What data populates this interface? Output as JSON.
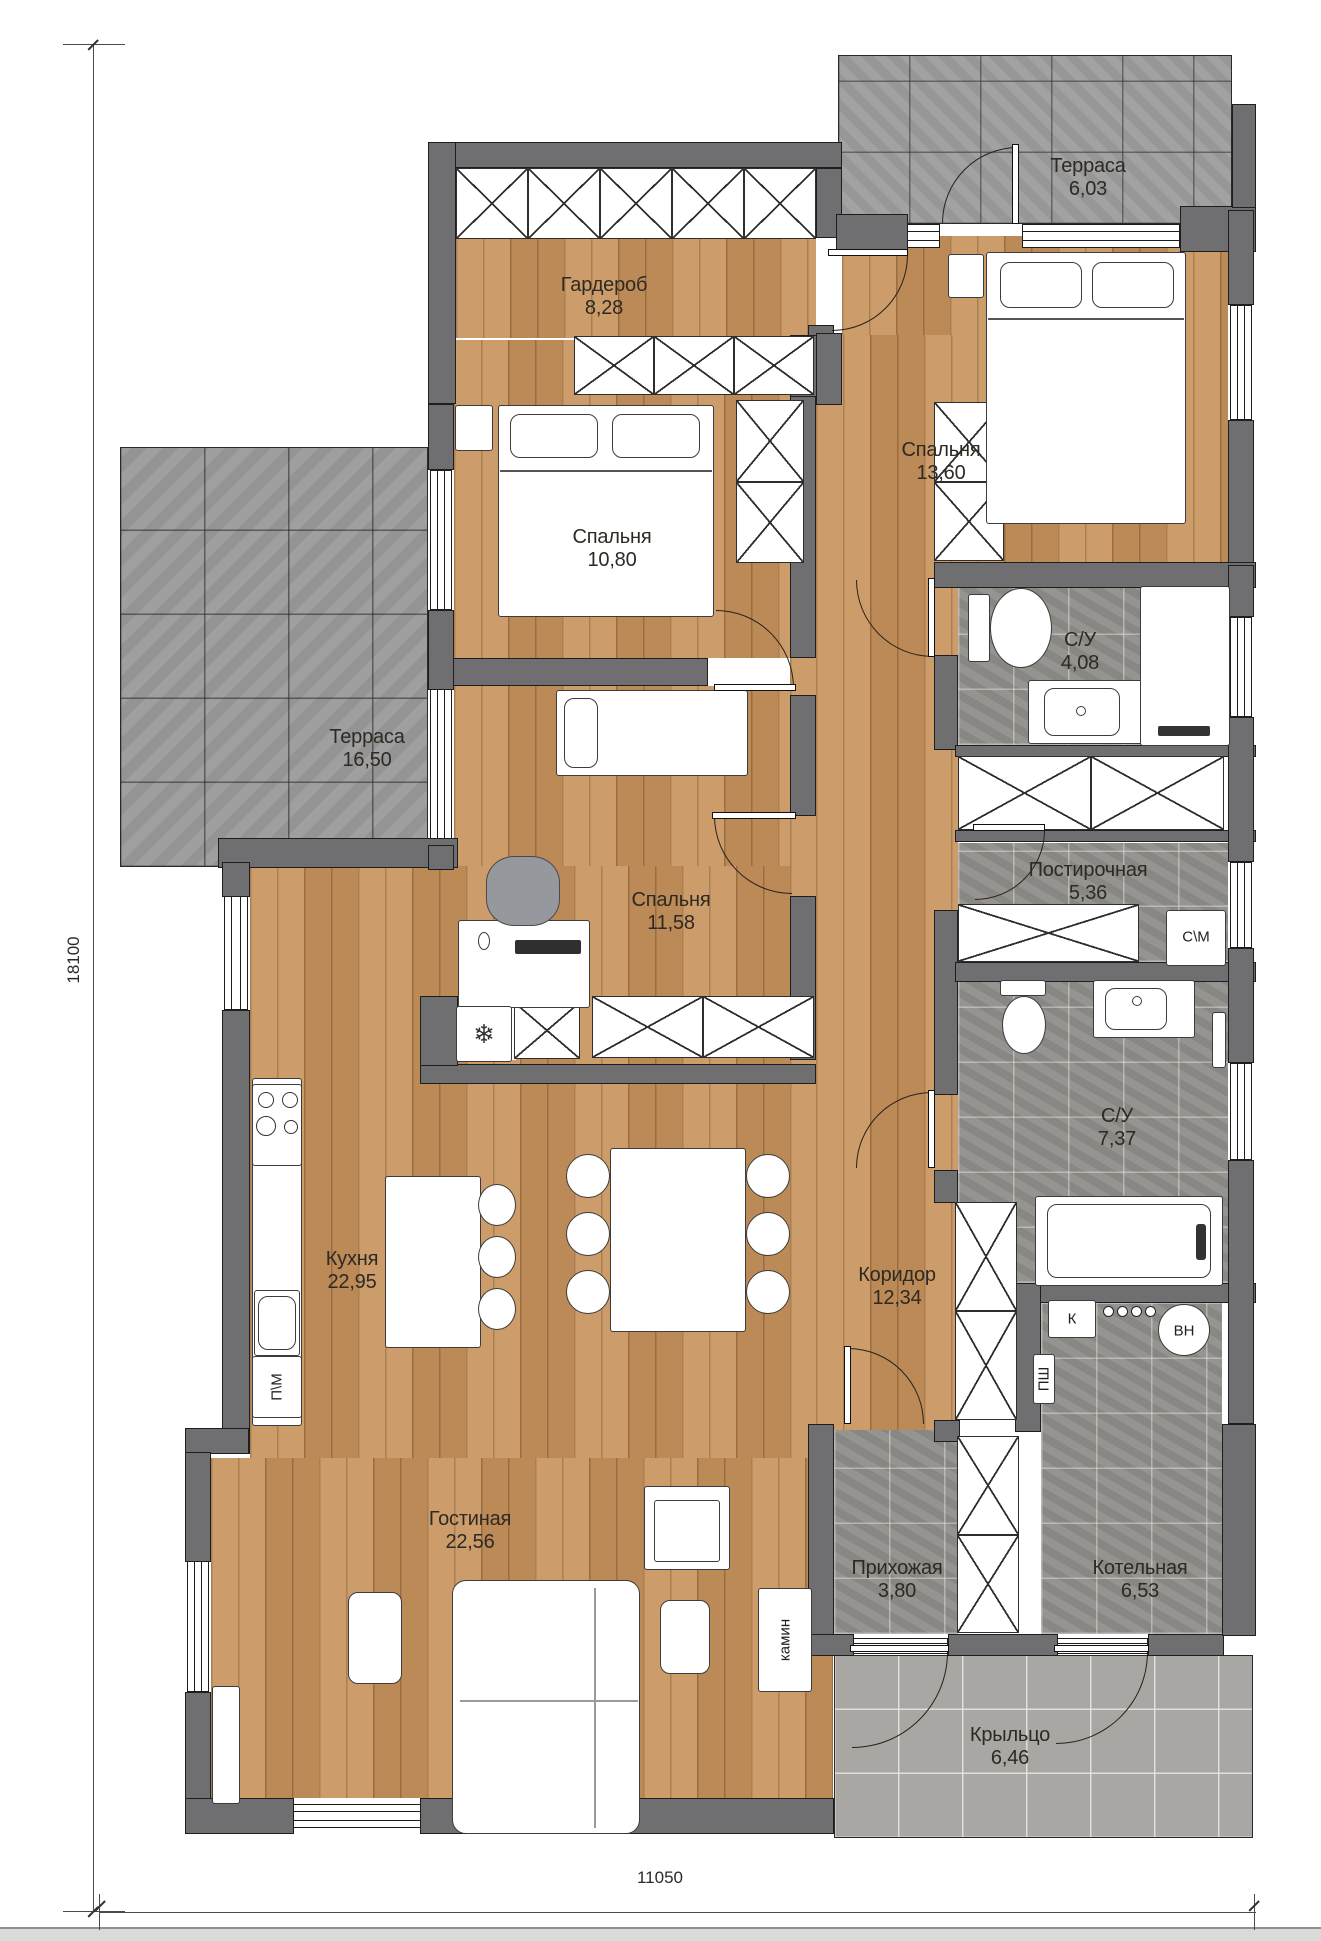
{
  "rooms": [
    {
      "id": "terrace-top",
      "name": "Терраса",
      "area": "6,03"
    },
    {
      "id": "wardrobe",
      "name": "Гардероб",
      "area": "8,28"
    },
    {
      "id": "bedroom-1",
      "name": "Спальня",
      "area": "13,60"
    },
    {
      "id": "bedroom-2",
      "name": "Спальня",
      "area": "10,80"
    },
    {
      "id": "terrace-left",
      "name": "Терраса",
      "area": "16,50"
    },
    {
      "id": "bathroom-1",
      "name": "С/У",
      "area": "4,08"
    },
    {
      "id": "laundry",
      "name": "Постирочная",
      "area": "5,36"
    },
    {
      "id": "bedroom-3",
      "name": "Спальня",
      "area": "11,58"
    },
    {
      "id": "bathroom-2",
      "name": "С/У",
      "area": "7,37"
    },
    {
      "id": "kitchen",
      "name": "Кухня",
      "area": "22,95"
    },
    {
      "id": "corridor",
      "name": "Коридор",
      "area": "12,34"
    },
    {
      "id": "living-room",
      "name": "Гостиная",
      "area": "22,56"
    },
    {
      "id": "hallway",
      "name": "Прихожая",
      "area": "3,80"
    },
    {
      "id": "boiler-room",
      "name": "Котельная",
      "area": "6,53"
    },
    {
      "id": "porch",
      "name": "Крыльцо",
      "area": "6,46"
    }
  ],
  "dimensions": {
    "vertical": "18100",
    "horizontal": "11050"
  },
  "equipment": [
    {
      "id": "washing-machine",
      "label": "С\\М"
    },
    {
      "id": "dishwasher",
      "label": "П\\М"
    },
    {
      "id": "fireplace",
      "label": "камин"
    },
    {
      "id": "boiler",
      "label": "К"
    },
    {
      "id": "water-heater",
      "label": "ВН"
    },
    {
      "id": "cabinet",
      "label": "ПШ"
    }
  ],
  "icons": {
    "fridge": "❄"
  },
  "colors": {
    "wall": "#6f6f71",
    "wood": "#c6945f",
    "tile_light": "#9d9d9d",
    "tile_dark": "#908e8b",
    "tile_porch": "#a9a7a3",
    "line": "#1c1c1c"
  }
}
